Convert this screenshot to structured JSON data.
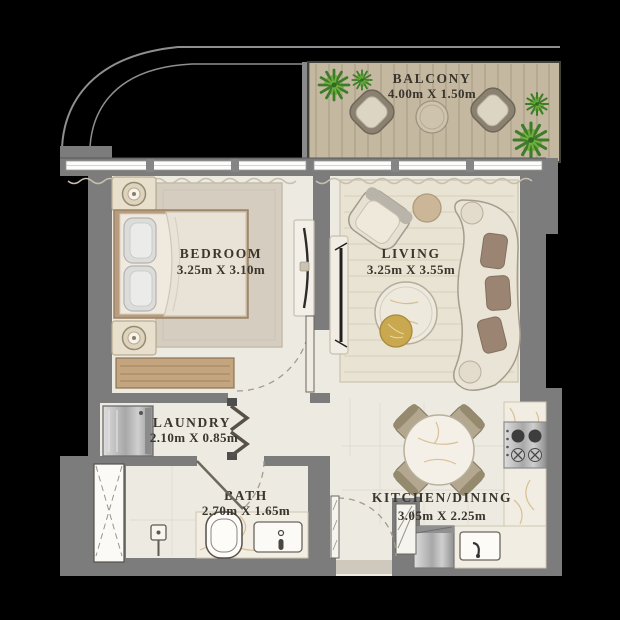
{
  "plan": {
    "rooms": {
      "balcony": {
        "name": "BALCONY",
        "dims": "4.00m X 1.50m"
      },
      "bedroom": {
        "name": "BEDROOM",
        "dims": "3.25m X 3.10m"
      },
      "living": {
        "name": "LIVING",
        "dims": "3.25m X 3.55m"
      },
      "laundry": {
        "name": "LAUNDRY",
        "dims": "2.10m X 0.85m"
      },
      "bath": {
        "name": "BATH",
        "dims": "2.70m X 1.65m"
      },
      "kitchen": {
        "name": "KITCHEN/DINING",
        "dims": "3.05m X 2.25m"
      }
    },
    "colors": {
      "background": "#000000",
      "wall": "#7c7c7c",
      "floor": "#edeae2",
      "balcony_deck": "#c5b8a1",
      "wood": "#c3a57f",
      "marble": "#f2ede2",
      "marble_vein": "#c6a263",
      "rug_bedroom": "#d5cec0",
      "rug_living": "#e9e3d4",
      "sofa_cushion": "#9b8472",
      "plant_green": "#3e7c28",
      "steel": "#b9b9b9",
      "label_text": "#3a352d"
    }
  }
}
